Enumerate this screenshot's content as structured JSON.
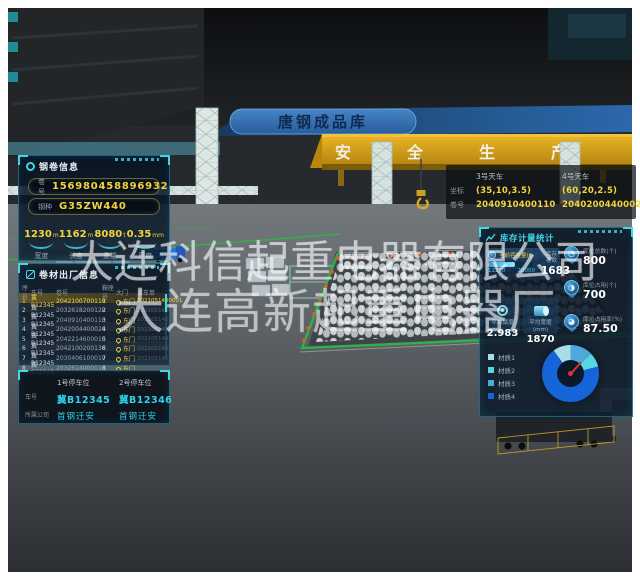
{
  "scene": {
    "banner_title": "唐钢成品库",
    "slogan_chars": [
      "安",
      "全",
      "生",
      "产"
    ]
  },
  "watermark": {
    "line1": "大连科信起重电器有限公司",
    "line2": "大连高新起重电器厂"
  },
  "coil_info_panel": {
    "title": "钢卷信息",
    "fields": [
      {
        "label": "卷号",
        "value": "156980458896932"
      },
      {
        "label": "钢种",
        "value": "G35ZW440"
      }
    ],
    "stats": [
      {
        "value": "1230",
        "unit": "m",
        "label": "宽度"
      },
      {
        "value": "1162",
        "unit": "m",
        "label": "长度"
      },
      {
        "value": "8080",
        "unit": "t",
        "label": "重量"
      },
      {
        "value": "0.35",
        "unit": "mm",
        "label": "厚度"
      }
    ]
  },
  "shipment_panel": {
    "title": "卷材出厂信息",
    "columns": [
      "序号",
      "车号",
      "卷号",
      "鞍座号",
      "大门",
      "派车单"
    ],
    "rows": [
      [
        "1",
        "冀B12345",
        "2042100700110",
        "1",
        "东门",
        "2021051400001"
      ],
      [
        "2",
        "冀B12345",
        "2032618200120",
        "2",
        "东门",
        "2021051400001"
      ],
      [
        "3",
        "冀B12345",
        "2040910400110",
        "3",
        "东门",
        "2021051400001"
      ],
      [
        "4",
        "冀B12345",
        "2042004400020",
        "4",
        "东门",
        "2021051400001"
      ],
      [
        "5",
        "冀B12345",
        "2042214600010",
        "5",
        "东门",
        "2021051400001"
      ],
      [
        "6",
        "冀B12345",
        "2042100200130",
        "6",
        "东门",
        "2021051400001"
      ],
      [
        "7",
        "冀B12345",
        "2030406100010",
        "7",
        "东门",
        "2021051400001"
      ],
      [
        "8",
        "冀B12345",
        "2032614000010",
        "8",
        "东门",
        "2021051400001"
      ]
    ]
  },
  "parking_panel": {
    "labels": {
      "plate": "车号",
      "company": "所属公司"
    },
    "spots": [
      {
        "title": "1号停车位",
        "plate": "冀B12345",
        "company": "首钢迁安"
      },
      {
        "title": "2号停车位",
        "plate": "冀B12346",
        "company": "首钢迁安"
      }
    ]
  },
  "crane_panel": {
    "headers": [
      "3号天车",
      "4号天车"
    ],
    "rows": [
      {
        "label": "坐标",
        "values": [
          "(35,10,3.5)",
          "(60,20,2.5)"
        ]
      },
      {
        "label": "卷号",
        "values": [
          "2040910400110",
          "20402004400020"
        ]
      }
    ]
  },
  "inventory_panel": {
    "title": "库存计量统计",
    "throughput": {
      "label": "当前吞吐量(t)",
      "current": 12230,
      "max": 20000
    },
    "coil_count": {
      "label": "库存卷数",
      "value": "1683"
    },
    "right_stats": [
      {
        "label": "库位总数(个)",
        "value": "800",
        "icon_glyph": "◔"
      },
      {
        "label": "库位占用(个)",
        "value": "700",
        "icon_glyph": "◑"
      },
      {
        "label": "库位占用率(%)",
        "value": "87.50",
        "icon_glyph": "◕"
      }
    ],
    "avg_stats": [
      {
        "label": "平均厚度",
        "unit": "",
        "value": "2.983"
      },
      {
        "label": "平均宽度",
        "unit": "(mm)",
        "value": "1870"
      }
    ]
  },
  "chart_data": {
    "type": "pie",
    "title": "材质占比",
    "legend_position": "left",
    "segments": [
      {
        "label": "材质2",
        "value": 13,
        "color": "#4fa8dc"
      },
      {
        "label": "材质3",
        "value": 8,
        "color": "#56d8e4"
      },
      {
        "label": "材质4",
        "value": 69,
        "color": "#1565d8"
      },
      {
        "label": "材质1",
        "value": 10,
        "color": "#a8dde8"
      }
    ],
    "legend": [
      {
        "label": "材质1",
        "color": "#a8dde8"
      },
      {
        "label": "材质2",
        "color": "#56d8e4"
      },
      {
        "label": "材质3",
        "color": "#4fa8dc"
      },
      {
        "label": "材质4",
        "color": "#1565d8"
      }
    ]
  },
  "colors": {
    "accent": "#35c8e8",
    "highlight": "#f2d43c",
    "safety_green": "#2fb347"
  }
}
